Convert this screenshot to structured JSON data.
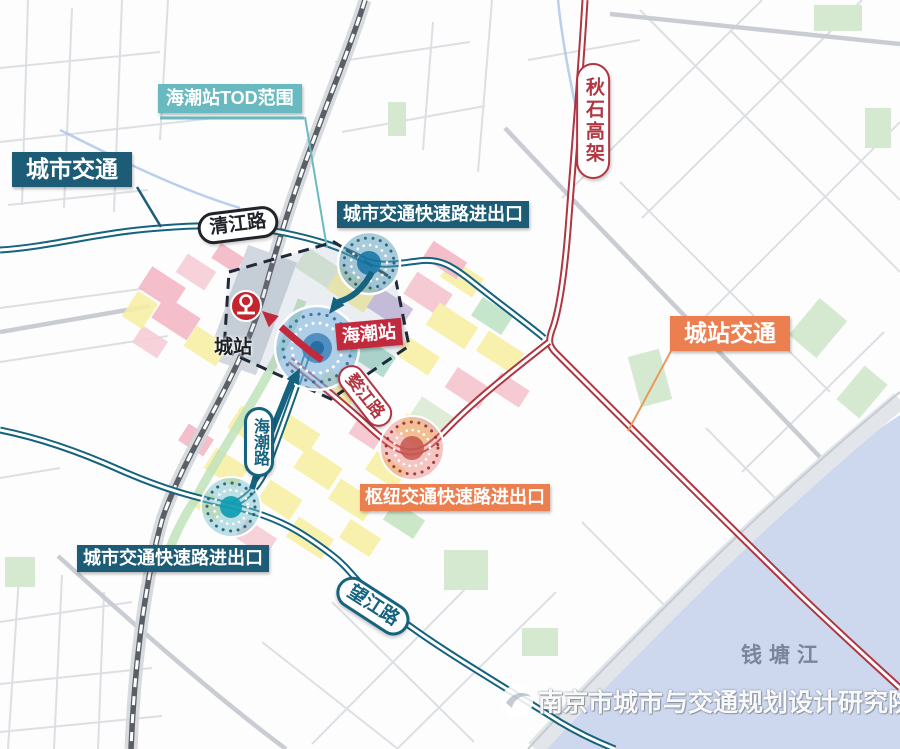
{
  "labels": {
    "tod_scope": "海潮站TOD范围",
    "city_traffic": "城市交通",
    "city_expressway_exit": "城市交通快速路进出口",
    "hub_expressway_exit": "枢纽交通快速路进出口",
    "station_traffic": "城站交通"
  },
  "stations": {
    "haichao": "海潮站",
    "chengzhan": "城站"
  },
  "roads": {
    "qingjiang": "清江路",
    "qiushi_viaduct": "秋石高架",
    "wujiang": "婺江路",
    "haichao_road": "海潮路",
    "wangjiang": "望江路"
  },
  "water": {
    "qiantang_river": "钱塘江"
  },
  "watermark": {
    "text": "南京市城市与交通规划设计研究院"
  },
  "colors": {
    "dark_teal": "#1d5c76",
    "teal": "#68bac0",
    "orange": "#ec7f50",
    "red": "#c2293c",
    "road_teal": "#15637e",
    "road_red": "#b03642",
    "river": "#cdd8ef"
  }
}
